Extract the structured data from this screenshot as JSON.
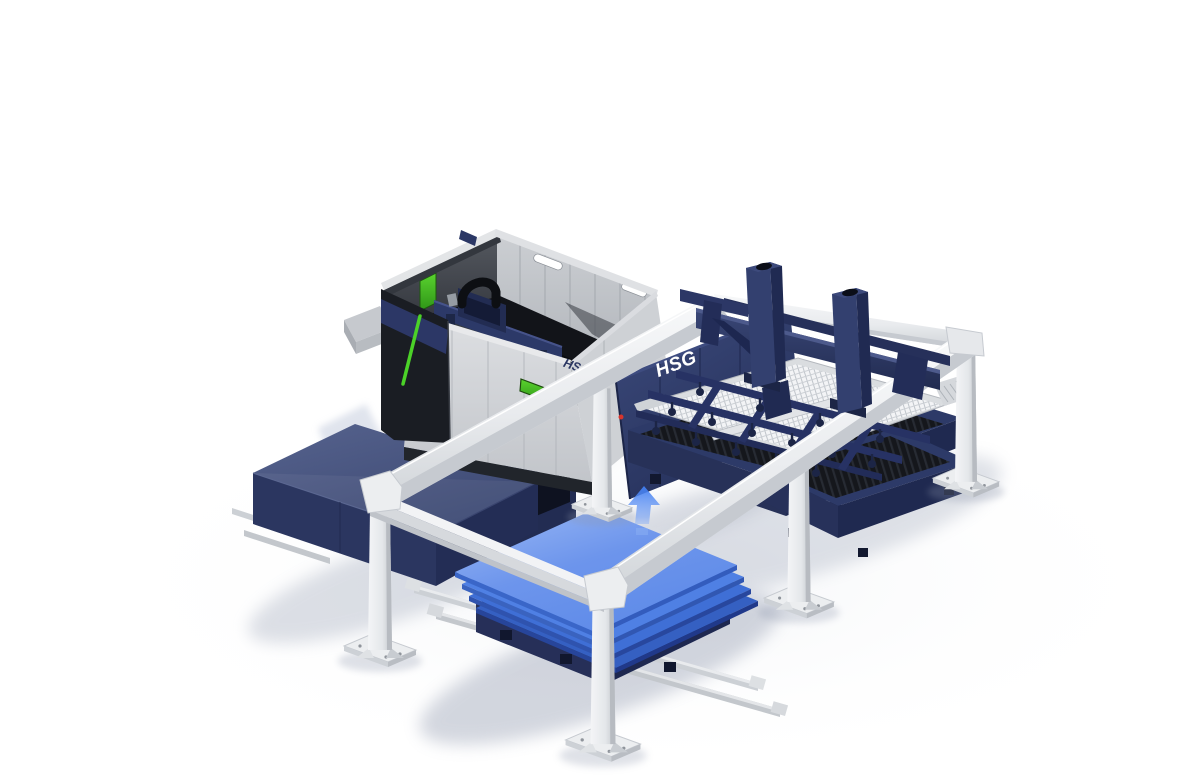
{
  "image": {
    "type": "3d-product-render",
    "subject": "HSG fiber laser cutting machine with automatic sheet metal loading and unloading gantry system",
    "background": "#ffffff"
  },
  "branding": {
    "machine_front_logo": "HSG",
    "loader_module_logo": "HSG"
  },
  "palette": {
    "logo_navy": "#2b3763",
    "logo_white": "#ffffff",
    "navy": "#2d3a68",
    "navy_dark": "#222c52",
    "navy_light": "#3e4c80",
    "machine_gray": "#d6d8db",
    "machine_gray_dark": "#b9bcc1",
    "frame_black": "#1b1e24",
    "accent_green": "#4bd228",
    "window_green": "#3f9718",
    "sheet_blue_top": "#8fb0f2",
    "sheet_blue": "#4f80e4",
    "sheet_blue_dark": "#3560c2",
    "arrow_blue": "#3f7df2",
    "beam_white": "#f2f3f5",
    "beam_shade": "#c3c7cc",
    "rail_silver": "#cdd1d6",
    "slat_black": "#15171c"
  },
  "objects": {
    "laser_machine": "fiber laser cutting machine",
    "laser_head": "cutting head bridge",
    "loader_gantry": "white gantry frame",
    "vacuum_crossbeam": "loading crossbeam with vacuum posts",
    "suction_frame": "suction cup frame",
    "honeycomb_pallet": "honeycomb cutting pallet",
    "shuttle_table_1": "exchange pallet table",
    "shuttle_table_2": "exchange pallet table",
    "sheet_stack": "stack of blue metal sheets",
    "material_cart": "material cart on rails",
    "cover_station": "covered unloading station",
    "up_arrow": "loading direction arrow"
  }
}
